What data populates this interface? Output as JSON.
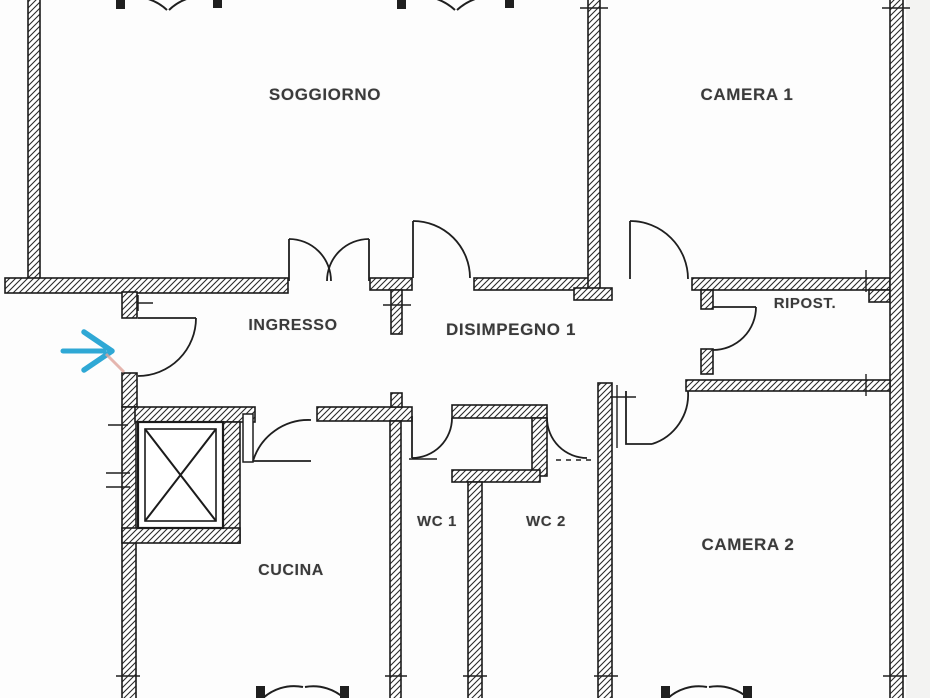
{
  "title": "Apartment floor plan",
  "rooms": {
    "soggiorno": "SOGGIORNO",
    "camera1": "CAMERA 1",
    "ingresso": "INGRESSO",
    "disimpegno1": "DISIMPEGNO 1",
    "ripostiglio": "RIPOST.",
    "cucina": "CUCINA",
    "wc1": "WC 1",
    "wc2": "WC 2",
    "camera2": "CAMERA 2"
  },
  "colors": {
    "wall_line": "#1b1b1b",
    "hatch_line": "#2a2a2a",
    "label_text": "#3a3a3a",
    "entrance_arrow": "#2fa8d5",
    "entrance_mark": "#dfa49b",
    "background": "#fdfdfd"
  },
  "icons": {
    "entrance_arrow": "entrance-direction-arrow",
    "elevator": "elevator-shaft-x"
  }
}
